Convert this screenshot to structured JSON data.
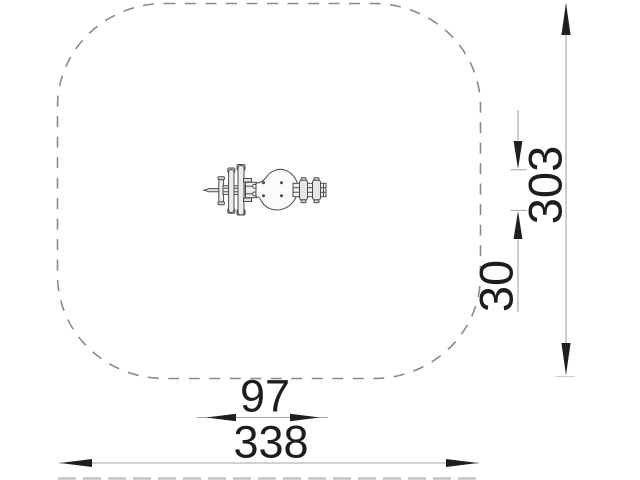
{
  "drawing": {
    "kind": "dimensioned plan view, spring-rider on safety zone",
    "labels": {
      "total_width": "338",
      "total_height": "303",
      "equipment_length": "97",
      "equipment_width": "30"
    },
    "colors": {
      "background": "#ffffff",
      "zone_outline": "#8a8a8a",
      "dimension_line": "#a3a3a3",
      "arrow_and_text": "#1d1d1d",
      "equipment_line": "#4a4a4a"
    }
  }
}
